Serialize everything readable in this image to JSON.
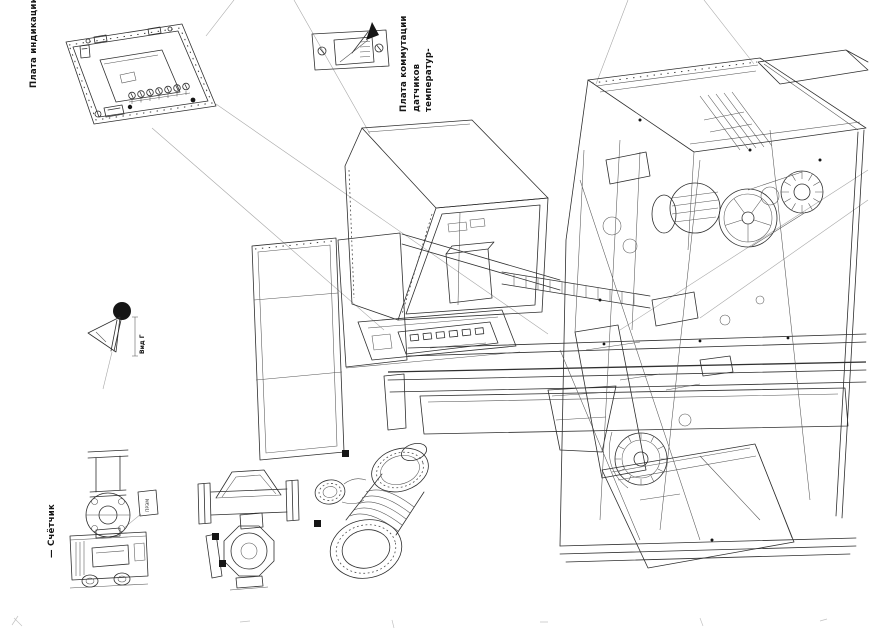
{
  "page": {
    "kind": "scanned technical exploded-view drawing, page rotated 90 degrees",
    "colors": {
      "paper": "#ffffff",
      "ink": "#2f2f2f",
      "faint_lines": "#a8a8a8",
      "text": "#151515"
    }
  },
  "labels": {
    "panel_label": "Плата индикации",
    "commutation_lines": [
      "Плата коммутации",
      "датчиков",
      "температур-"
    ],
    "sensor_view_label": "Вид Г",
    "counter_label": "— Счётчик",
    "device_tag": "ПРЭМ"
  },
  "components": [
    "indicator-panel-lid",
    "temperature-sensor-commutation-board",
    "control-cabinet",
    "terminal-tray",
    "cable-chain",
    "long-bed-rails",
    "side-enclosure-panels",
    "discharge-chute",
    "machine-frame-assembly",
    "motor",
    "spoked-pulley",
    "ribbed-disc",
    "fan-impeller",
    "level-sensor-with-knob",
    "flow-counter-unit",
    "flanged-flow-sensor",
    "electromagnetic-flowmeter"
  ]
}
